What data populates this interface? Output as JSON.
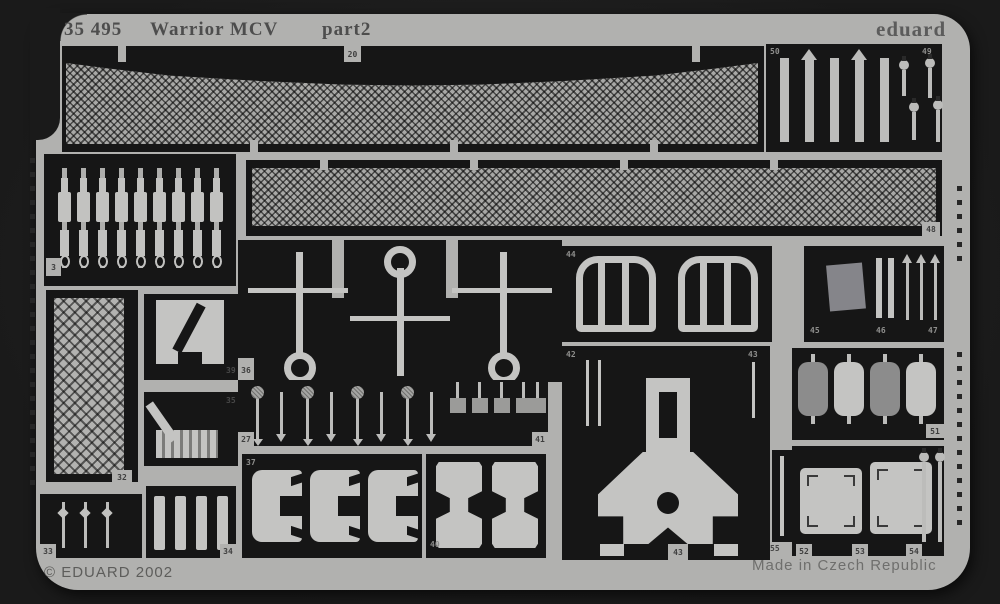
{
  "header": {
    "catalog_number": "35 495",
    "product_name": "Warrior MCV",
    "sheet_part": "part2",
    "brand": "eduard"
  },
  "footer": {
    "copyright": "© EDUARD 2002",
    "origin": "Made in Czech Republic"
  },
  "sheet": {
    "colors": {
      "background": "#1a1a1a",
      "fret": "#b1b1af",
      "panel": "#161616",
      "part_light": "#c4c4c2",
      "part_gray": "#8c8c8c"
    },
    "parts": {
      "p3": "3",
      "p20": "20",
      "p27": "27",
      "p32": "32",
      "p33": "33",
      "p34": "34",
      "p35": "35",
      "p36": "36",
      "p37": "37",
      "p39": "39",
      "p40": "40",
      "p41": "41",
      "p42": "42",
      "p43": "43",
      "p44": "44",
      "p45": "45",
      "p46": "46",
      "p47": "47",
      "p48": "48",
      "p49": "49",
      "p50": "50",
      "p51": "51",
      "p52": "52",
      "p53": "53",
      "p54": "54",
      "p55": "55"
    }
  }
}
